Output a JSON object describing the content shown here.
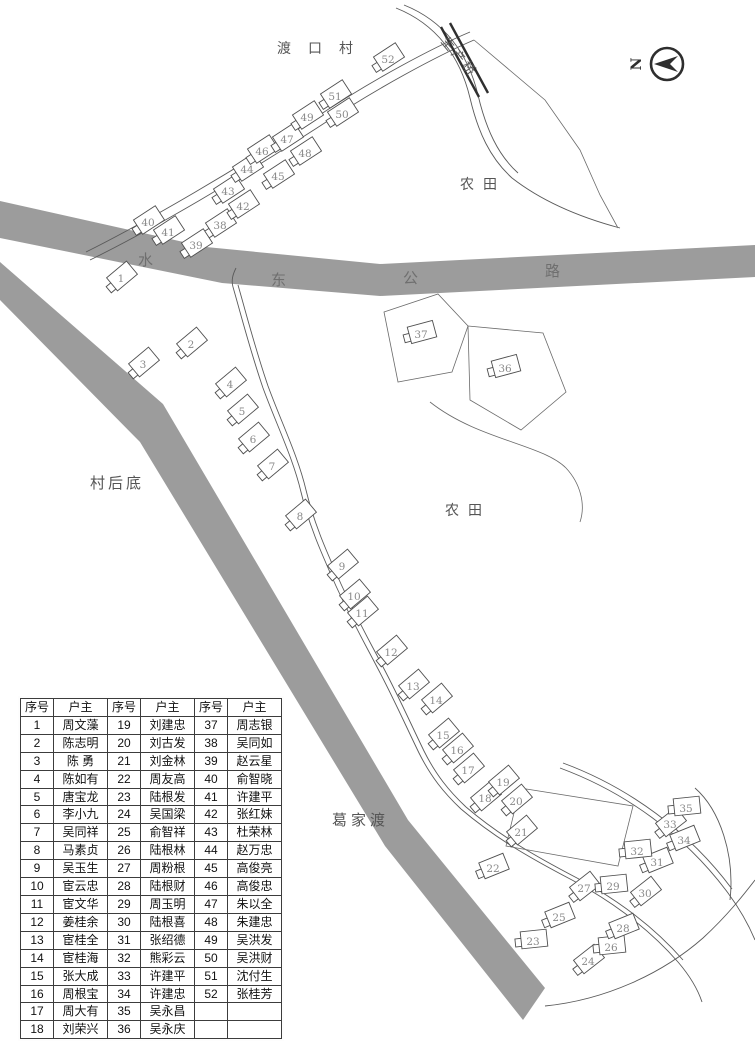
{
  "map": {
    "north_label": "N",
    "place_labels": {
      "village_name": "渡口村",
      "bridge": "生产桥",
      "farmland_top": "农田",
      "farmland_mid": "农田",
      "village_rear": "村后底",
      "ferry": "葛家渡"
    },
    "road_chars": [
      "水",
      "东",
      "公",
      "路"
    ],
    "buildings": [
      {
        "n": 1,
        "x": 121,
        "y": 279
      },
      {
        "n": 2,
        "x": 191,
        "y": 345
      },
      {
        "n": 3,
        "x": 143,
        "y": 365
      },
      {
        "n": 4,
        "x": 230,
        "y": 385
      },
      {
        "n": 5,
        "x": 242,
        "y": 412
      },
      {
        "n": 6,
        "x": 253,
        "y": 440
      },
      {
        "n": 7,
        "x": 272,
        "y": 467
      },
      {
        "n": 8,
        "x": 300,
        "y": 517
      },
      {
        "n": 9,
        "x": 342,
        "y": 567
      },
      {
        "n": 10,
        "x": 354,
        "y": 597
      },
      {
        "n": 11,
        "x": 362,
        "y": 614
      },
      {
        "n": 12,
        "x": 391,
        "y": 653
      },
      {
        "n": 13,
        "x": 413,
        "y": 687
      },
      {
        "n": 14,
        "x": 436,
        "y": 701
      },
      {
        "n": 15,
        "x": 443,
        "y": 736
      },
      {
        "n": 16,
        "x": 457,
        "y": 751
      },
      {
        "n": 17,
        "x": 468,
        "y": 771
      },
      {
        "n": 18,
        "x": 485,
        "y": 799
      },
      {
        "n": 19,
        "x": 503,
        "y": 783
      },
      {
        "n": 20,
        "x": 516,
        "y": 802
      },
      {
        "n": 21,
        "x": 521,
        "y": 833
      },
      {
        "n": 22,
        "x": 493,
        "y": 869
      },
      {
        "n": 23,
        "x": 533,
        "y": 942
      },
      {
        "n": 24,
        "x": 588,
        "y": 962
      },
      {
        "n": 25,
        "x": 559,
        "y": 918
      },
      {
        "n": 26,
        "x": 611,
        "y": 948
      },
      {
        "n": 27,
        "x": 584,
        "y": 889
      },
      {
        "n": 28,
        "x": 623,
        "y": 929
      },
      {
        "n": 29,
        "x": 613,
        "y": 887
      },
      {
        "n": 30,
        "x": 645,
        "y": 894
      },
      {
        "n": 31,
        "x": 657,
        "y": 863
      },
      {
        "n": 32,
        "x": 637,
        "y": 852
      },
      {
        "n": 33,
        "x": 670,
        "y": 825
      },
      {
        "n": 34,
        "x": 684,
        "y": 841
      },
      {
        "n": 35,
        "x": 686,
        "y": 809
      },
      {
        "n": 36,
        "x": 505,
        "y": 369
      },
      {
        "n": 37,
        "x": 421,
        "y": 335
      },
      {
        "n": 38,
        "x": 220,
        "y": 226
      },
      {
        "n": 39,
        "x": 196,
        "y": 246
      },
      {
        "n": 40,
        "x": 148,
        "y": 223
      },
      {
        "n": 41,
        "x": 168,
        "y": 233
      },
      {
        "n": 42,
        "x": 243,
        "y": 207
      },
      {
        "n": 43,
        "x": 228,
        "y": 192
      },
      {
        "n": 44,
        "x": 247,
        "y": 170
      },
      {
        "n": 45,
        "x": 278,
        "y": 177
      },
      {
        "n": 46,
        "x": 262,
        "y": 152
      },
      {
        "n": 47,
        "x": 287,
        "y": 140
      },
      {
        "n": 48,
        "x": 305,
        "y": 154
      },
      {
        "n": 49,
        "x": 307,
        "y": 118
      },
      {
        "n": 50,
        "x": 342,
        "y": 115
      },
      {
        "n": 51,
        "x": 335,
        "y": 97
      },
      {
        "n": 52,
        "x": 388,
        "y": 60
      }
    ]
  },
  "table": {
    "headers": [
      "序号",
      "户主",
      "序号",
      "户主",
      "序号",
      "户主"
    ],
    "rows": [
      [
        "1",
        "周文藻",
        "19",
        "刘建忠",
        "37",
        "周志银"
      ],
      [
        "2",
        "陈志明",
        "20",
        "刘古发",
        "38",
        "吴同如"
      ],
      [
        "3",
        "陈 勇",
        "21",
        "刘金林",
        "39",
        "赵云星"
      ],
      [
        "4",
        "陈如有",
        "22",
        "周友高",
        "40",
        "俞智晓"
      ],
      [
        "5",
        "唐宝龙",
        "23",
        "陆根发",
        "41",
        "许建平"
      ],
      [
        "6",
        "李小九",
        "24",
        "吴国梁",
        "42",
        "张红妹"
      ],
      [
        "7",
        "吴同祥",
        "25",
        "俞智祥",
        "43",
        "杜荣林"
      ],
      [
        "8",
        "马素贞",
        "26",
        "陆根林",
        "44",
        "赵万忠"
      ],
      [
        "9",
        "吴玉生",
        "27",
        "周粉根",
        "45",
        "高俊亮"
      ],
      [
        "10",
        "宦云忠",
        "28",
        "陆根财",
        "46",
        "高俊忠"
      ],
      [
        "11",
        "宦文华",
        "29",
        "周玉明",
        "47",
        "朱以全"
      ],
      [
        "12",
        "姜桂余",
        "30",
        "陆根喜",
        "48",
        "朱建忠"
      ],
      [
        "13",
        "宦桂全",
        "31",
        "张绍德",
        "49",
        "吴洪发"
      ],
      [
        "14",
        "宦桂海",
        "32",
        "熊彩云",
        "50",
        "吴洪财"
      ],
      [
        "15",
        "张大成",
        "33",
        "许建平",
        "51",
        "沈付生"
      ],
      [
        "16",
        "周根宝",
        "34",
        "许建忠",
        "52",
        "张桂芳"
      ],
      [
        "17",
        "周大有",
        "35",
        "吴永昌",
        "",
        ""
      ],
      [
        "18",
        "刘荣兴",
        "36",
        "吴永庆",
        "",
        ""
      ]
    ]
  },
  "colors": {
    "road": "#9c9c9c",
    "outline": "#4f4f4f",
    "number": "#8a8a8a",
    "label": "#555555"
  }
}
